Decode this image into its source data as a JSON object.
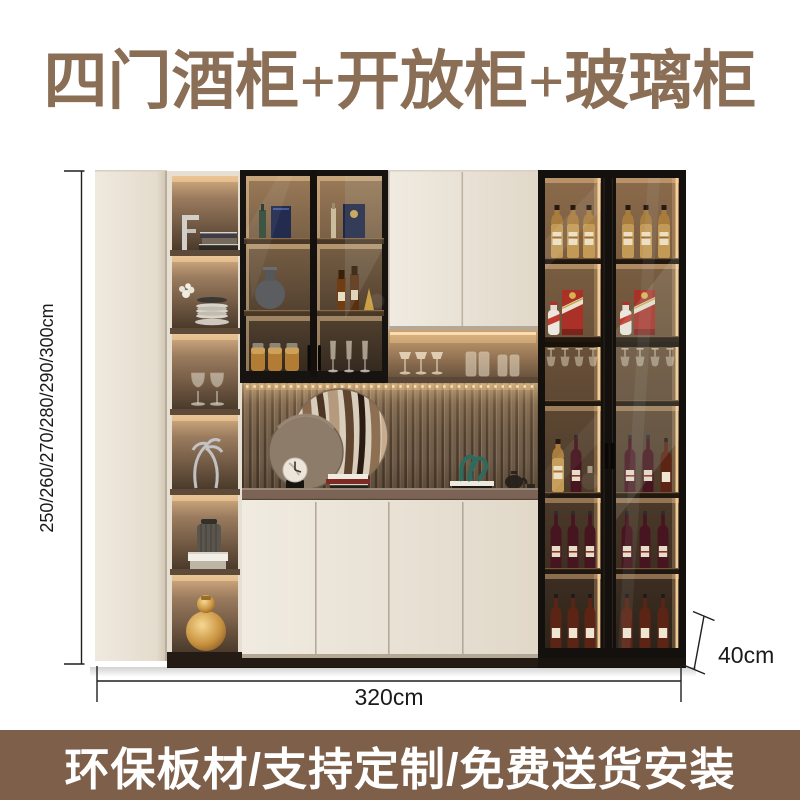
{
  "title": "四门酒柜+开放柜+玻璃柜",
  "banner": {
    "text": "环保板材/支持定制/免费送货安装",
    "background": "#7d5f4a",
    "text_color": "#ffffff"
  },
  "dimensions": {
    "height": "250/260/270/280/290/300cm",
    "width": "320cm",
    "depth": "40cm"
  },
  "colors": {
    "title_text": "#8a6e55",
    "dimension_text": "#1a1a1a",
    "cabinet_cream": "#eae2d6",
    "cabinet_frame_black": "#17130f",
    "wood_counter": "#7b6455",
    "led_warm": "#ffd9a2",
    "moutai_red": "#a93127"
  }
}
